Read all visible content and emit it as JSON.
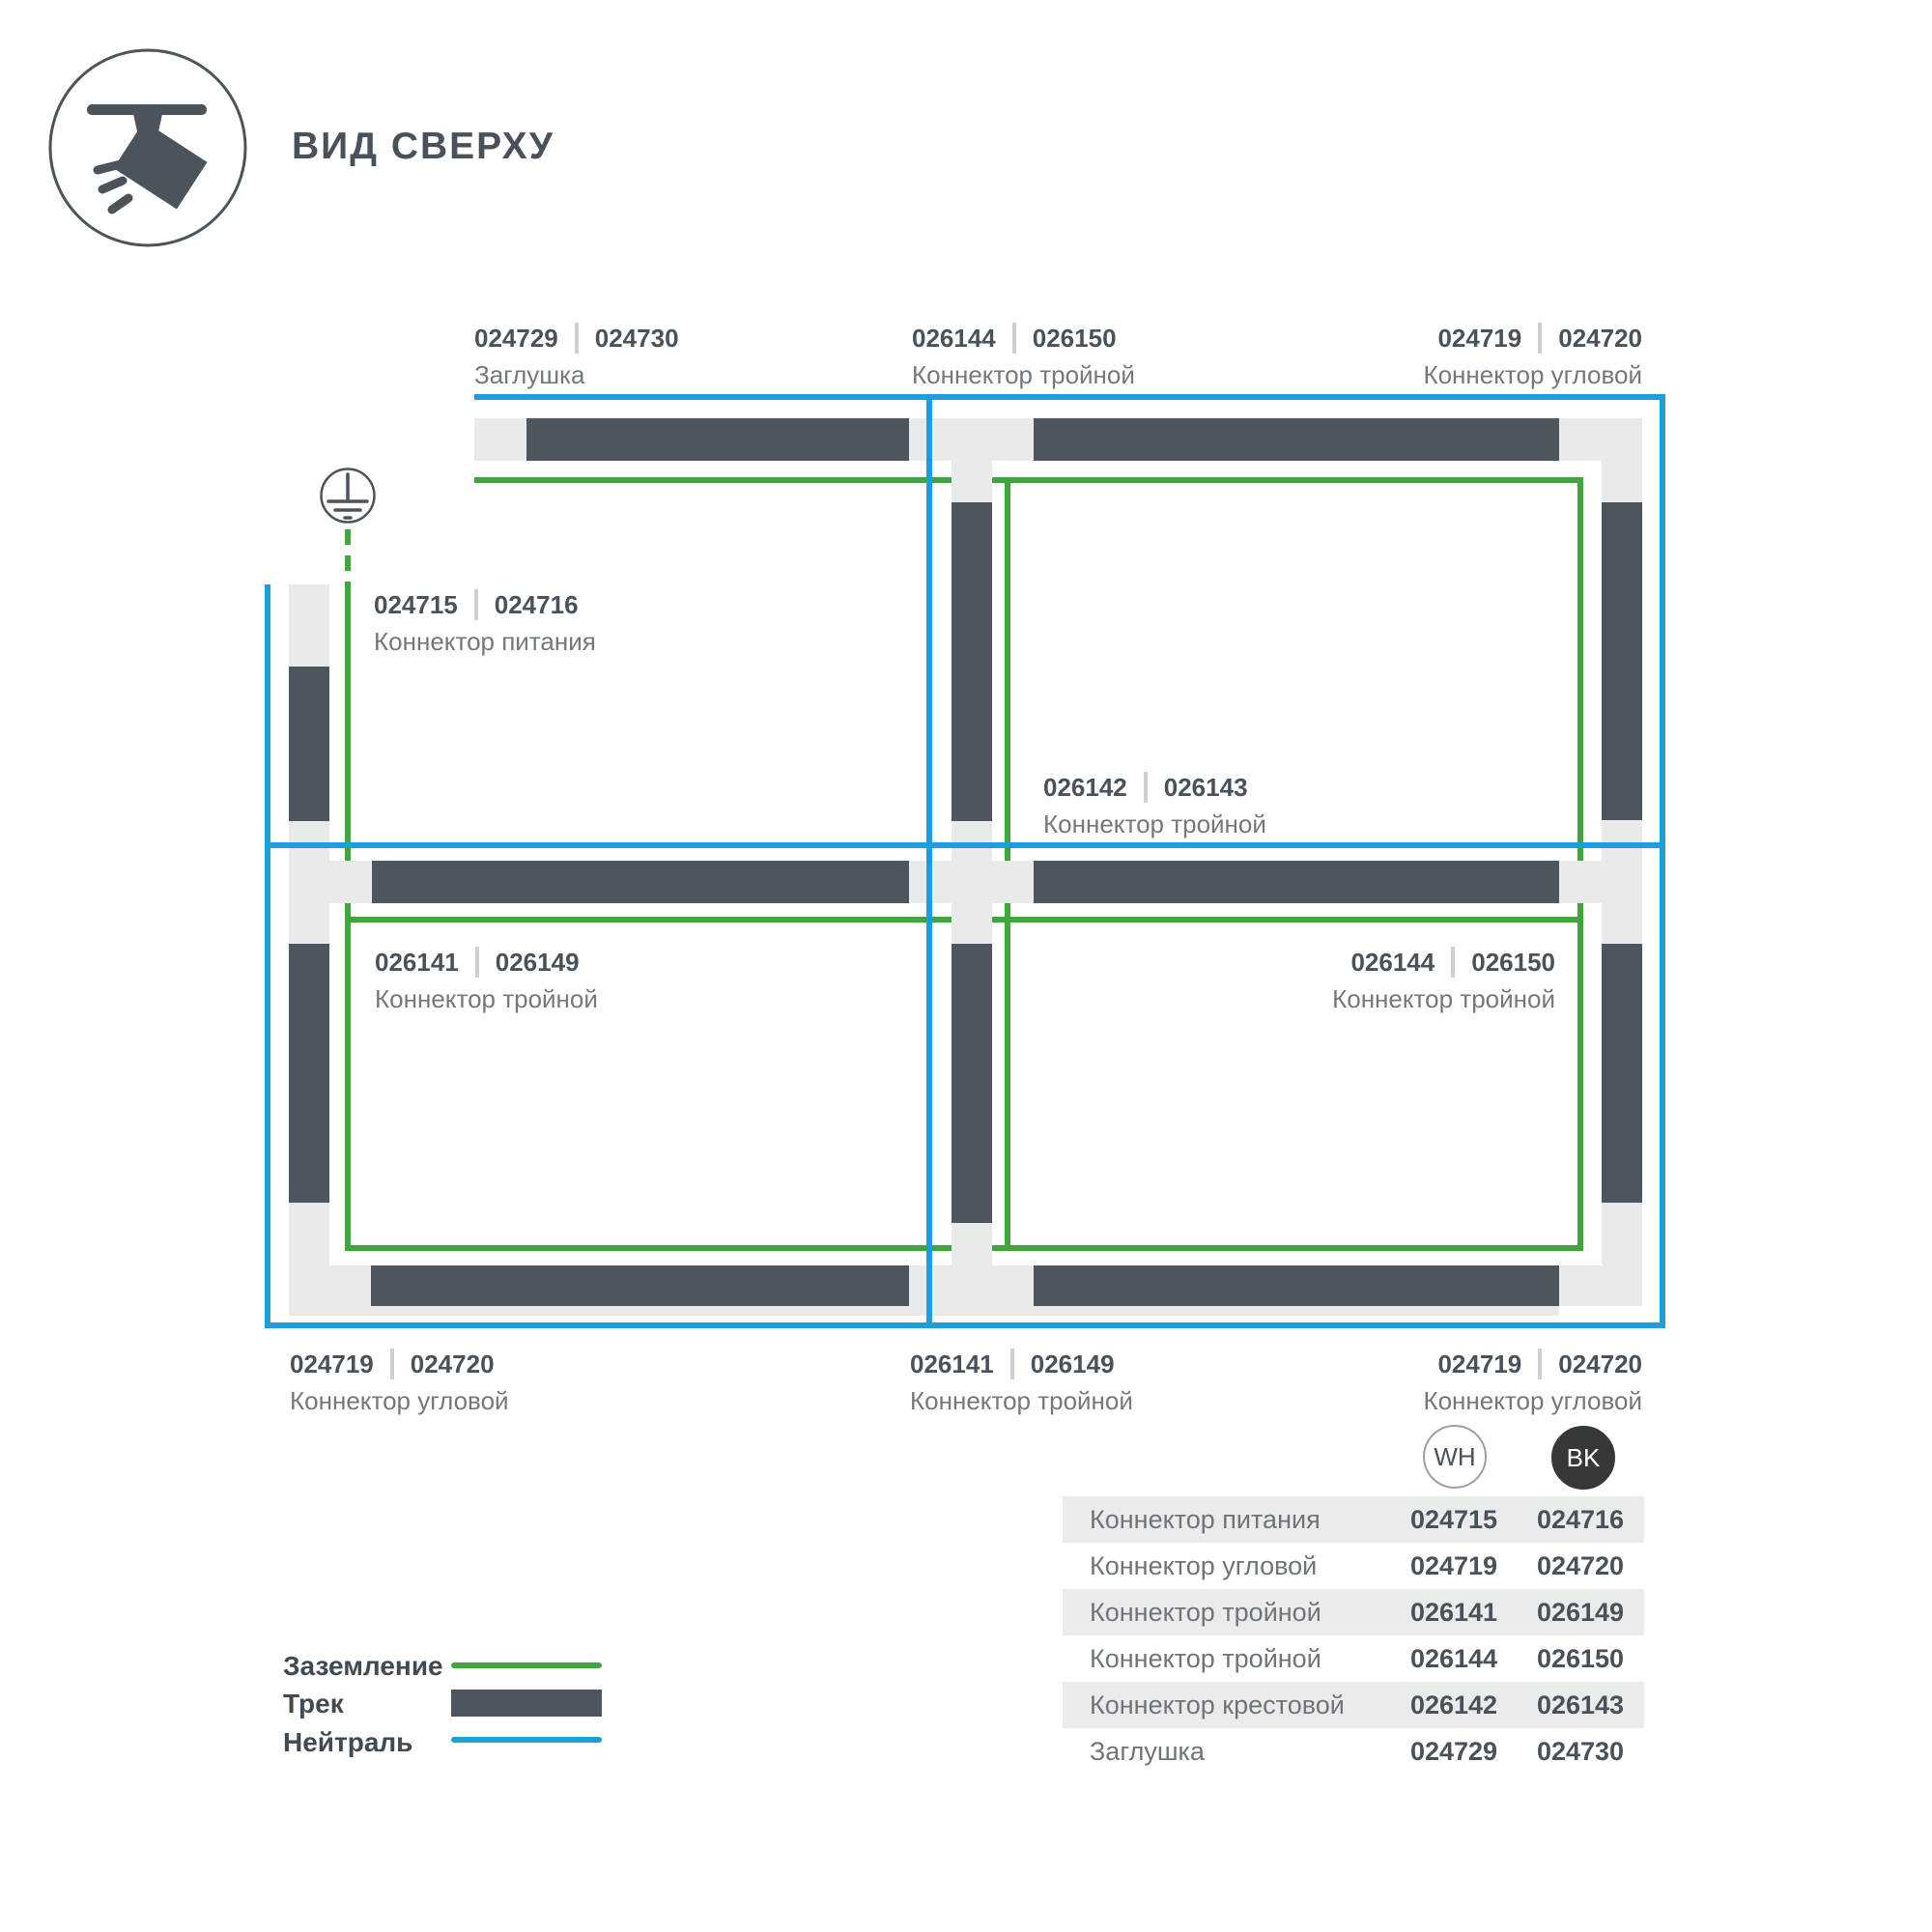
{
  "title": "ВИД СВЕРХУ",
  "colors": {
    "neutral_blue": "#1d9dd9",
    "ground_green": "#3fa63c",
    "track_dark": "#4d565e",
    "track_light": "#e9ebeb",
    "text_dark": "#49525a",
    "text_gray": "#73787c",
    "badge_black": "#35393b",
    "table_row_shaded": "#eaecec"
  },
  "icons": {
    "spotlight": "track-spotlight-icon",
    "ground": "ground-earth-icon"
  },
  "diagram": {
    "labels": [
      {
        "codes": [
          "024729",
          "024730"
        ],
        "name": "Заглушка"
      },
      {
        "codes": [
          "026144",
          "026150"
        ],
        "name": "Коннектор тройной"
      },
      {
        "codes": [
          "024719",
          "024720"
        ],
        "name": "Коннектор угловой"
      },
      {
        "codes": [
          "024715",
          "024716"
        ],
        "name": "Коннектор питания"
      },
      {
        "codes": [
          "026142",
          "026143"
        ],
        "name": "Коннектор тройной"
      },
      {
        "codes": [
          "026141",
          "026149"
        ],
        "name": "Коннектор тройной"
      },
      {
        "codes": [
          "026144",
          "026150"
        ],
        "name": "Коннектор тройной"
      },
      {
        "codes": [
          "024719",
          "024720"
        ],
        "name": "Коннектор угловой"
      },
      {
        "codes": [
          "026141",
          "026149"
        ],
        "name": "Коннектор тройной"
      },
      {
        "codes": [
          "024719",
          "024720"
        ],
        "name": "Коннектор угловой"
      }
    ]
  },
  "legend": {
    "items": [
      {
        "label": "Заземление"
      },
      {
        "label": "Трек"
      },
      {
        "label": "Нейтраль"
      }
    ]
  },
  "variants": {
    "wh": "WH",
    "bk": "BK"
  },
  "table": {
    "rows": [
      {
        "name": "Коннектор питания",
        "wh": "024715",
        "bk": "024716"
      },
      {
        "name": "Коннектор угловой",
        "wh": "024719",
        "bk": "024720"
      },
      {
        "name": "Коннектор тройной",
        "wh": "026141",
        "bk": "026149"
      },
      {
        "name": "Коннектор тройной",
        "wh": "026144",
        "bk": "026150"
      },
      {
        "name": "Коннектор крестовой",
        "wh": "026142",
        "bk": "026143"
      },
      {
        "name": "Заглушка",
        "wh": "024729",
        "bk": "024730"
      }
    ]
  }
}
